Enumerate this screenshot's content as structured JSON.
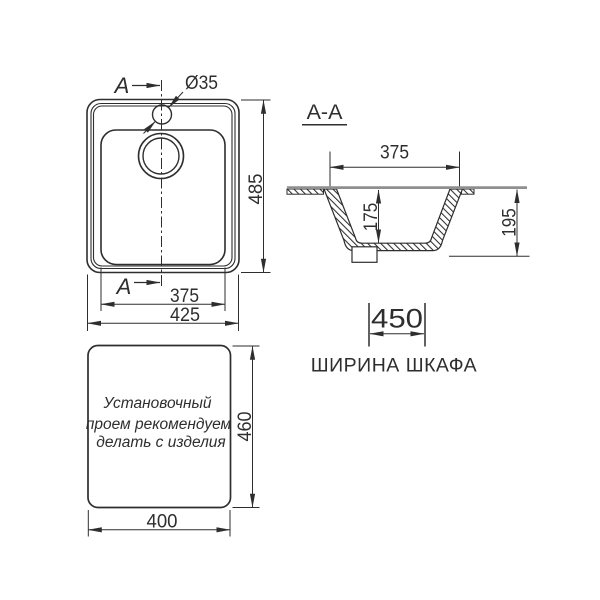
{
  "top_view": {
    "section_arrow_top": "A",
    "section_arrow_bottom": "A",
    "faucet_hole_dia": "Ø35",
    "height": "485",
    "bowl_width": "375",
    "width": "425"
  },
  "section_view": {
    "title": "А-А",
    "bowl_width": "375",
    "bowl_depth": "175",
    "total_depth": "195"
  },
  "cabinet": {
    "width": "450",
    "label": "ШИРИНА ШКАФА"
  },
  "cutout_view": {
    "note_lines": [
      "Установочный",
      "проем рекомендуем",
      "делать с изделия"
    ],
    "height": "460",
    "width": "400"
  },
  "colors": {
    "line": "#2e2e2e",
    "countertop_line": "#8f8f8f"
  }
}
